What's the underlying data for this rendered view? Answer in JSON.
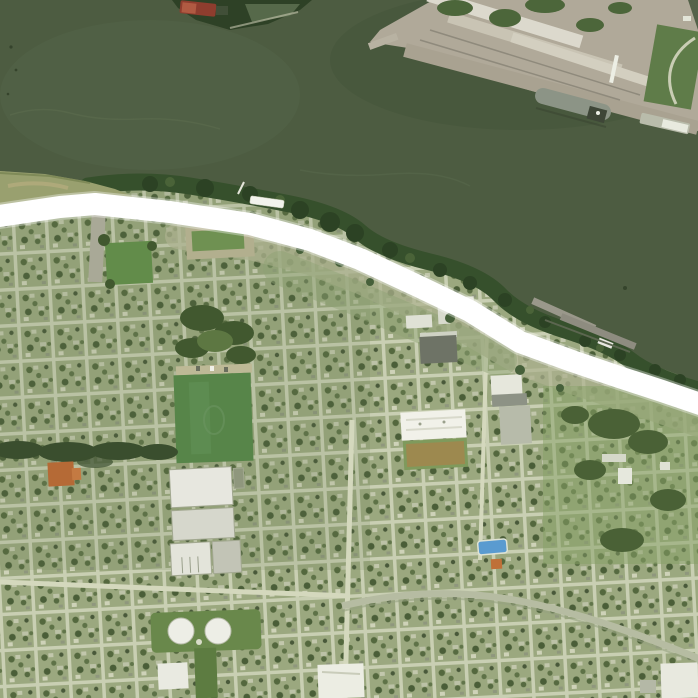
{
  "scene": {
    "type": "aerial-satellite-view",
    "alt_text": "Aerial satellite view of a riverside city: dark green river across the top, industrial wharf with moored ship on the far bank, a thick white highlighted levee route following the near shoreline, and a dense residential street grid with parks, warehouses, storage tanks and commercial buildings below."
  },
  "colors": {
    "water": "#4d5c41",
    "water_deep": "#46553b",
    "water_light": "#56664a",
    "land_base": "#a9b28d",
    "city_block": "#9ba87f",
    "street": "#c9cfb3",
    "route_highlight": "#ffffff",
    "shore_trees": "#36502c",
    "grass_point": "#99a06f",
    "cleared_earth": "#adb08f",
    "park_field": "#578549",
    "small_field": "#628c4a",
    "tree_dark": "#3a4e2e",
    "orange_roof": "#b56a36",
    "warehouse_white": "#e7e7df",
    "warehouse_gray": "#d6d7cc",
    "tank_white": "#edeee6",
    "tank_pad": "#69884b",
    "school_white": "#f1f1e9",
    "ball_field_brown": "#9d894f",
    "dark_building": "#6e7366",
    "pool_blue": "#5a9bd0",
    "right_lots_green": "#86a065",
    "curve_road": "#b6bca2",
    "wharf_concrete": "#b0a999",
    "wharf_warehouse": "#dcd9cd",
    "wharf_green": "#4c663a",
    "ship_hull": "#8c9486",
    "ship_stern": "#3e4637",
    "barge_gray": "#b9bcab",
    "barge_red": "#8e3d2e",
    "boat_white": "#f2f3ec",
    "dock_gray": "#9a988b",
    "point_trees": "#2e4126"
  },
  "features": [
    "river",
    "industrial-wharf",
    "cargo-ship",
    "moored-barge",
    "river-point-with-red-barge",
    "shoreline-trees",
    "levee-route-highlight",
    "grass-point",
    "white-boat",
    "shore-docks",
    "residential-grid",
    "park-field",
    "warehouse-complex",
    "storage-tanks",
    "orange-building",
    "school-building",
    "athletic-field",
    "swimming-pool",
    "curving-road",
    "green-lots"
  ]
}
